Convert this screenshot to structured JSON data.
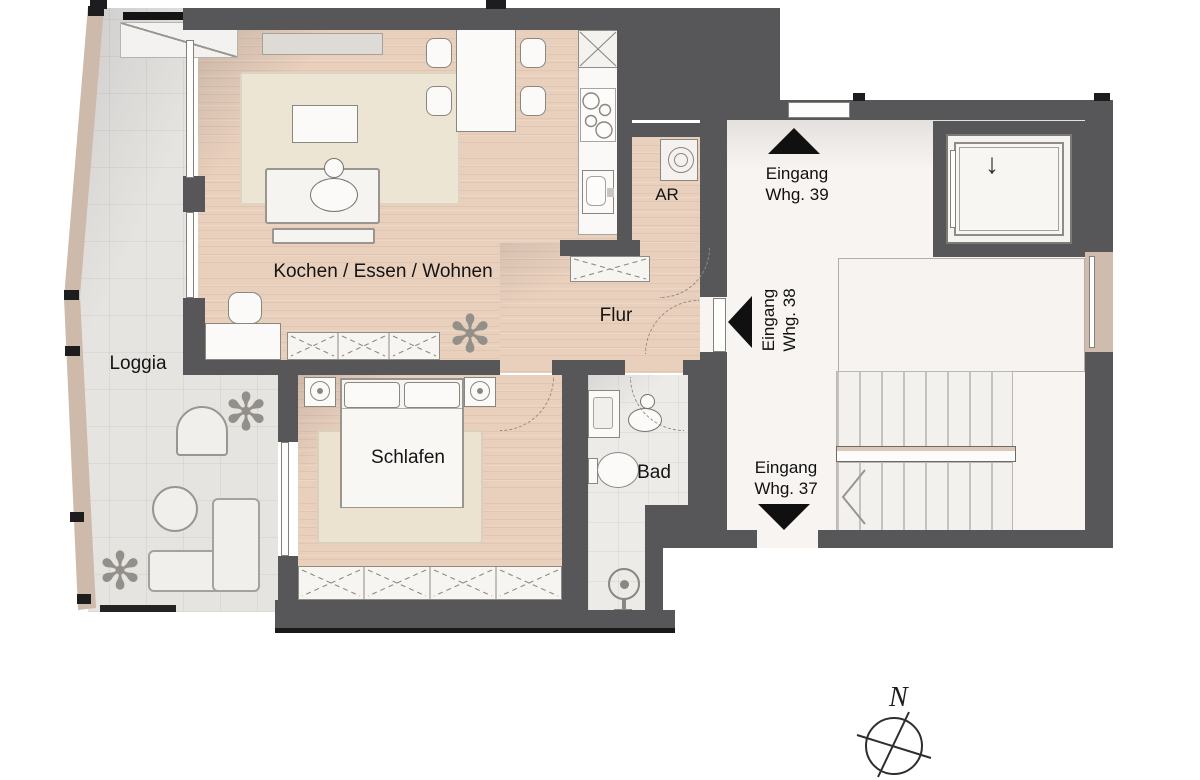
{
  "rooms": {
    "living": {
      "label": "Kochen / Essen / Wohnen"
    },
    "loggia": {
      "label": "Loggia"
    },
    "bedroom": {
      "label": "Schlafen"
    },
    "hallway": {
      "label": "Flur"
    },
    "bathroom": {
      "label": "Bad"
    },
    "storage": {
      "label": "AR"
    }
  },
  "entrances": {
    "whg39": {
      "line1": "Eingang",
      "line2": "Whg. 39",
      "direction": "up"
    },
    "whg38": {
      "line1": "Eingang",
      "line2": "Whg. 38",
      "direction": "left"
    },
    "whg37": {
      "line1": "Eingang",
      "line2": "Whg. 37",
      "direction": "down"
    }
  },
  "stairwell": {
    "elevator_arrow": "↓"
  },
  "compass": {
    "label": "N"
  },
  "icons": {
    "plant": "✻"
  },
  "colors": {
    "wall": "#57575a",
    "wood_floor": "#e9d0bd",
    "loggia_tile": "#e6e4e1",
    "bath_tile": "#edebe8",
    "stair_floor": "#f7f4f1",
    "rug": "#ece4d1",
    "loggia_band": "#cdbaab",
    "arrow": "#101010"
  }
}
